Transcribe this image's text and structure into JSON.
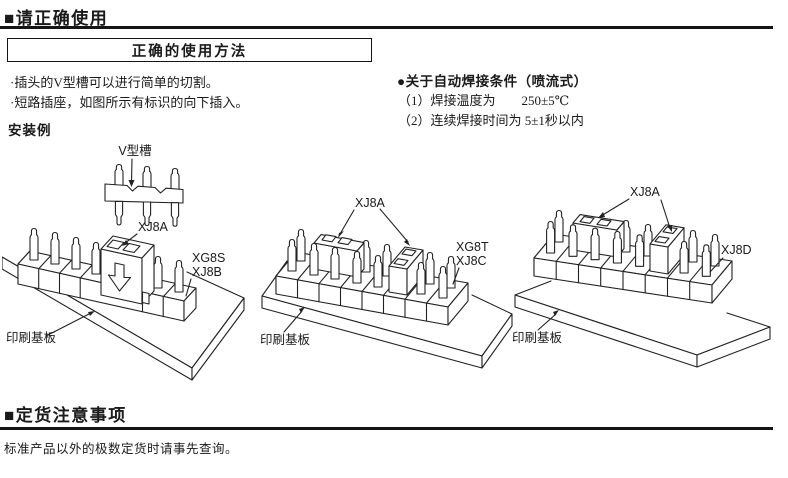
{
  "section_usage": {
    "marker": "■",
    "heading": "请正确使用",
    "box_title": "正确的使用方法",
    "bullet1": "·插头的V型槽可以进行简单的切割。",
    "bullet2": "·短路插座，如图所示有标识的向下插入。",
    "solder_heading": "●关于自动焊接条件（喷流式）",
    "solder_item1": "（1）焊接温度为　　250±5℃",
    "solder_item2": "（2）连续焊接时间为 5±1秒以内",
    "example_label": "安装例"
  },
  "diagram1": {
    "v_groove_label": "V型槽",
    "jumper_label": "XJ8A",
    "strip_label_line1": "XG8S",
    "strip_label_line2": "XJ8B",
    "pcb_label": "印刷基板"
  },
  "diagram2": {
    "jumper_label": "XJ8A",
    "strip_label_line1": "XG8T",
    "strip_label_line2": "XJ8C",
    "pcb_label": "印刷基板"
  },
  "diagram3": {
    "jumper_label": "XJ8A",
    "strip_label": "XJ8D",
    "pcb_label": "印刷基板"
  },
  "section_order": {
    "marker": "■",
    "heading": "定货注意事项",
    "note": "标准产品以外的极数定货时请事先查询。"
  },
  "colors": {
    "ink": "#1a1a1a",
    "line": "#222222",
    "background": "#ffffff"
  }
}
